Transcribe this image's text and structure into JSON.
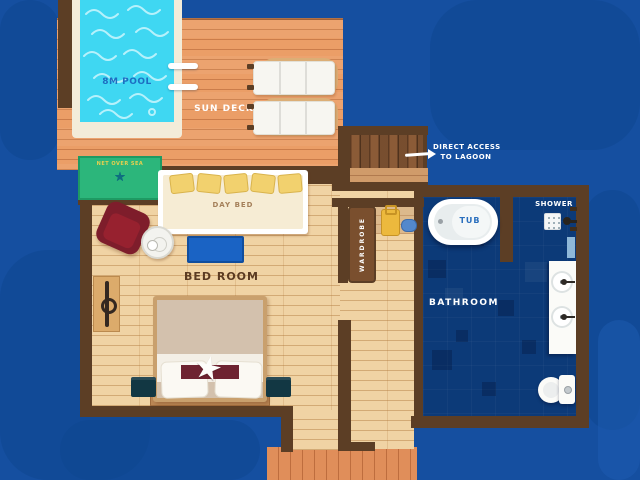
{
  "plan": {
    "pool": {
      "label": "8M POOL"
    },
    "sun_deck": {
      "label": "SUN DECK"
    },
    "net_day_bed": {
      "label": "NET OVER SEA"
    },
    "day_bed": {
      "label": "DAY BED"
    },
    "bedroom": {
      "label": "BED ROOM"
    },
    "wardrobe": {
      "label": "WARDROBE"
    },
    "bathroom": {
      "label": "BATHROOM"
    },
    "tub": {
      "label": "TUB"
    },
    "shower": {
      "label": "SHOWER"
    },
    "lagoon_access": {
      "line1": "DIRECT ACCESS",
      "line2": "TO LAGOON"
    },
    "icons": {
      "starfish": "★"
    },
    "colors": {
      "water": "#154fa0",
      "deck_wood": "#eb9e67",
      "interior_wood": "#f0d3a4",
      "entry_wood": "#e08e5a",
      "wall_brown": "#5c3e25",
      "pool_water": "#3fd7f2",
      "pool_frame": "#f3ecd9",
      "bathroom_floor": "#0c3a78",
      "net_green": "#2cb67b",
      "label_blue": "#1d6ec2",
      "label_white": "#ffffff",
      "label_brown": "#5b3b22",
      "armchair_red": "#7e1d2b",
      "rug_blue": "#1a63c4"
    }
  }
}
